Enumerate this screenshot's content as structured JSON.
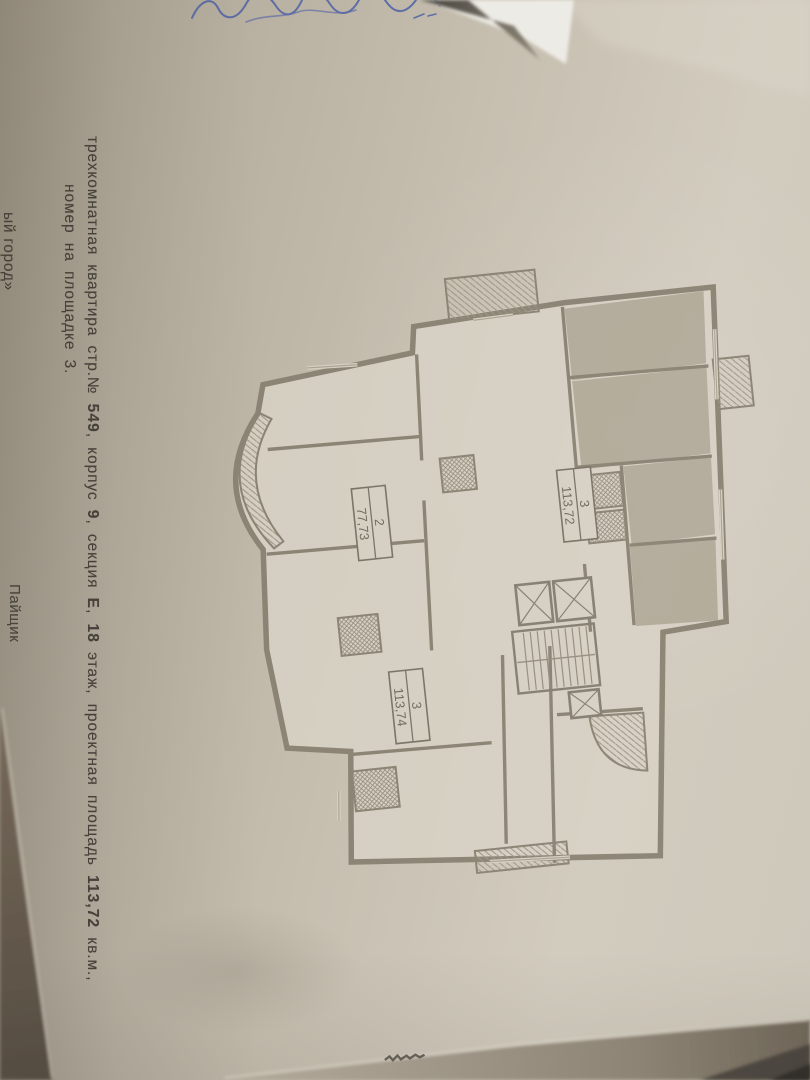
{
  "document": {
    "line1": [
      {
        "t": "трехкомнатная квартира стр.№ ",
        "b": 0
      },
      {
        "t": "549",
        "b": 1
      },
      {
        "t": ", корпус ",
        "b": 0
      },
      {
        "t": "9",
        "b": 1
      },
      {
        "t": ", секция ",
        "b": 0
      },
      {
        "t": "Е",
        "b": 1
      },
      {
        "t": ", ",
        "b": 0
      },
      {
        "t": "18",
        "b": 1
      },
      {
        "t": " этаж, проектная площадь ",
        "b": 0
      },
      {
        "t": "113,72",
        "b": 1
      },
      {
        "t": " кв.м.,",
        "b": 0
      }
    ],
    "line2": "номер на площадке 3.",
    "signer_label": "Пайщик",
    "footer_left_partial": "ый город»"
  },
  "plan": {
    "labels": [
      {
        "num": "2",
        "area": "77,73"
      },
      {
        "num": "3",
        "area": "113,72"
      },
      {
        "num": "3",
        "area": "113,74"
      }
    ]
  },
  "colors": {
    "ink_blue": "#4b5ea6",
    "paper": "#c6bfb0",
    "plan_wall_gray": "#837c6d",
    "plan_room_gray": "#b0a897",
    "background_dark": "#5f564a"
  }
}
